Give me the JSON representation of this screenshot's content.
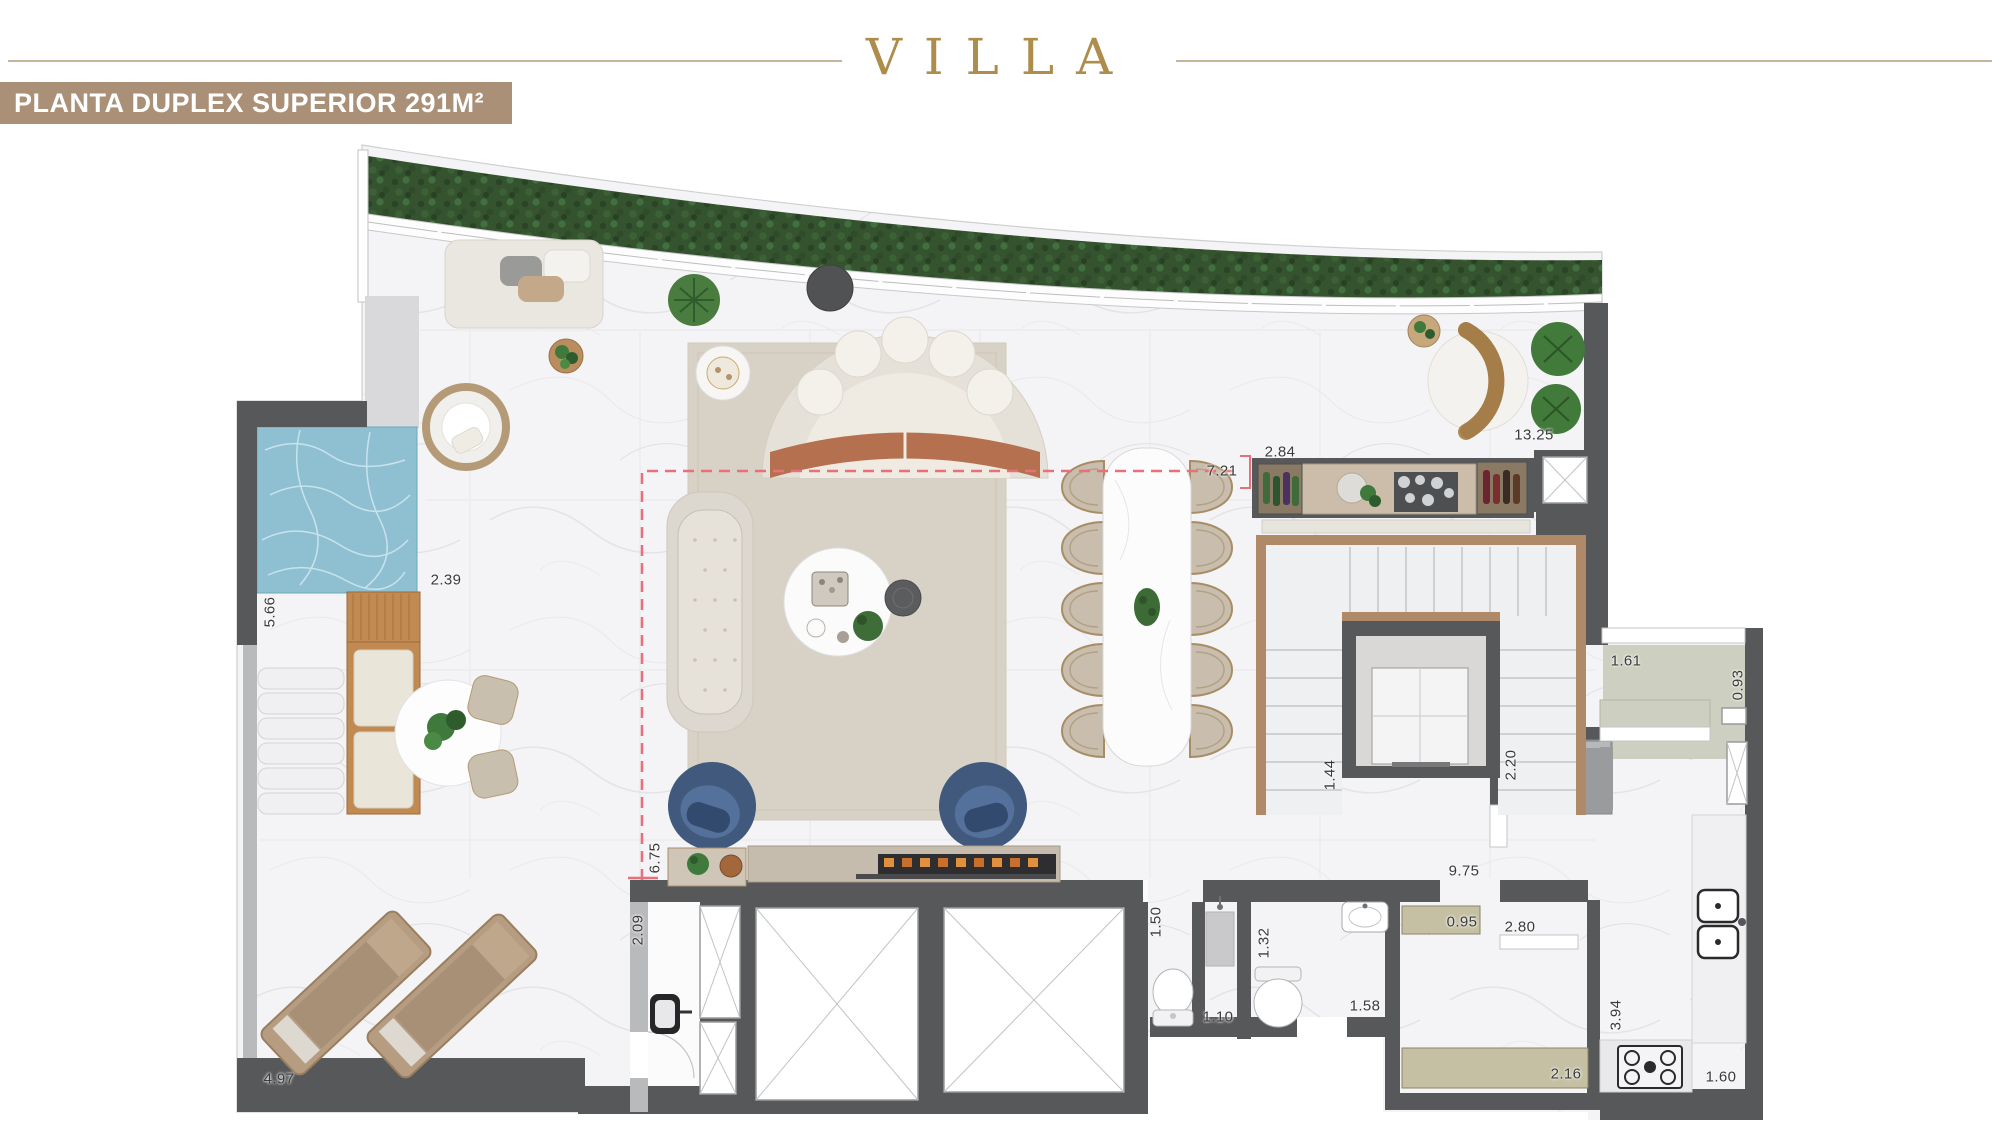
{
  "header": {
    "logo_text": "VILLA",
    "banner_title": "PLANTA DUPLEX SUPERIOR 291M²"
  },
  "colors": {
    "gold": "#ae8c4c",
    "gold_line": "#c9b49b",
    "banner_bg": "#ab9078",
    "banner_text": "#ffffff",
    "wall_dark": "#57585a",
    "wall_light": "#b9babc",
    "hedge_green": "#35532f",
    "pool_blue": "#8fc0d2",
    "wood": "#b08968",
    "rug": "#d8d2c6",
    "sage": "#cdcfc0",
    "khaki": "#c5c0a3",
    "dash_red": "#e8707a",
    "label_text": "#3b3b3d"
  },
  "plan": {
    "dimension_labels": [
      {
        "text": "5.66",
        "x": 270,
        "y": 612,
        "vertical": true
      },
      {
        "text": "2.39",
        "x": 446,
        "y": 580,
        "vertical": false
      },
      {
        "text": "4.97",
        "x": 279,
        "y": 1079,
        "vertical": false
      },
      {
        "text": "6.75",
        "x": 655,
        "y": 858,
        "vertical": true
      },
      {
        "text": "2.09",
        "x": 638,
        "y": 930,
        "vertical": true
      },
      {
        "text": "7.21",
        "x": 1222,
        "y": 471,
        "vertical": false
      },
      {
        "text": "2.84",
        "x": 1280,
        "y": 452,
        "vertical": false
      },
      {
        "text": "13.25",
        "x": 1534,
        "y": 435,
        "vertical": false
      },
      {
        "text": "1.61",
        "x": 1626,
        "y": 661,
        "vertical": false
      },
      {
        "text": "0.93",
        "x": 1738,
        "y": 685,
        "vertical": true
      },
      {
        "text": "1.44",
        "x": 1330,
        "y": 775,
        "vertical": true
      },
      {
        "text": "2.20",
        "x": 1511,
        "y": 765,
        "vertical": true
      },
      {
        "text": "9.75",
        "x": 1464,
        "y": 871,
        "vertical": false
      },
      {
        "text": "1.50",
        "x": 1156,
        "y": 922,
        "vertical": true
      },
      {
        "text": "1.32",
        "x": 1264,
        "y": 943,
        "vertical": true
      },
      {
        "text": "1.10",
        "x": 1218,
        "y": 1017,
        "vertical": false
      },
      {
        "text": "1.58",
        "x": 1365,
        "y": 1006,
        "vertical": false
      },
      {
        "text": "0.95",
        "x": 1462,
        "y": 922,
        "vertical": false
      },
      {
        "text": "2.80",
        "x": 1520,
        "y": 927,
        "vertical": false
      },
      {
        "text": "2.16",
        "x": 1566,
        "y": 1074,
        "vertical": false
      },
      {
        "text": "3.94",
        "x": 1616,
        "y": 1015,
        "vertical": true
      },
      {
        "text": "1.60",
        "x": 1721,
        "y": 1077,
        "vertical": false
      }
    ]
  }
}
